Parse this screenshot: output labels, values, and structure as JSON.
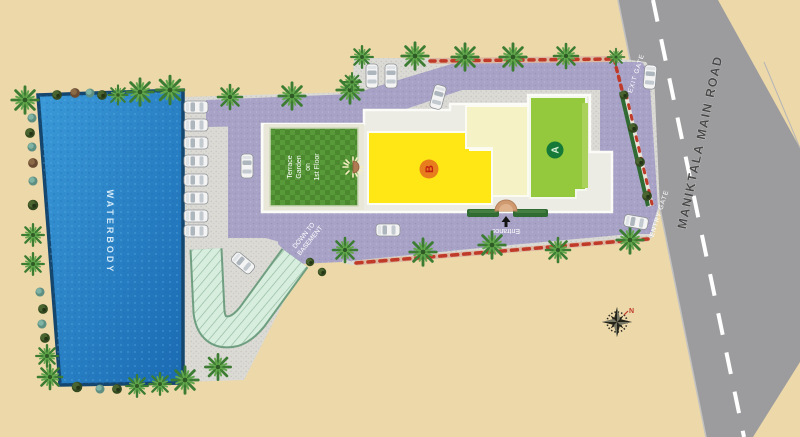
{
  "site_plan": {
    "labels": {
      "waterbody": "WATERBODY",
      "road": "MANIKTALA MAIN ROAD",
      "exit_gate": "EXIT GATE",
      "entry_gate": "ENTRY GATE",
      "entrance": "Entrance",
      "ramp_line1": "DOWN TO",
      "ramp_line2": "BASEMENT",
      "terrace_line1": "Terrace",
      "terrace_line2": "Garden",
      "terrace_line3": "on",
      "terrace_line4": "1st Floor",
      "building_a": "A",
      "building_b": "B",
      "compass_north": "N"
    },
    "colors": {
      "background": "#ecd8a9",
      "road": "#9c9c9e",
      "road_dash": "#ffffff",
      "pavement": "#dbdad5",
      "driveway": "#a8a3c6",
      "water": "#2387cd",
      "water_border": "#14466e",
      "ramp_fill": "#d7edde",
      "ramp_border": "#6f9f80",
      "terrace_green": "#4c892e",
      "building_b_fill": "#ffe715",
      "building_b_badge": "#e87d1e",
      "building_b_letter": "#c21f10",
      "building_mid_fill": "#f5f2c6",
      "building_a_fill": "#94c83d",
      "building_a_badge": "#157a38",
      "hedge": "#2f6b33",
      "flowers": "#bf3a28",
      "compass_north_color": "#c0392b"
    },
    "counts": {
      "cars_parked_left": 8,
      "cars_parked_top": 2,
      "cars_on_driveway": 4,
      "cars_at_gates": 2
    }
  }
}
